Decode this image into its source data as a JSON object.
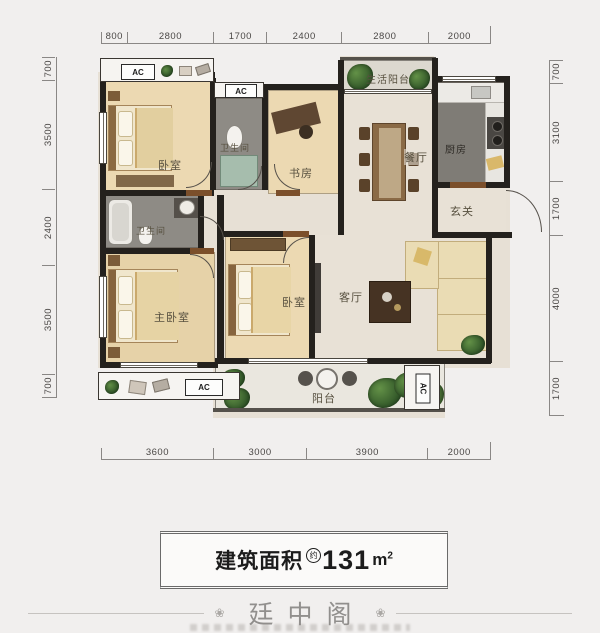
{
  "plan": {
    "dimensions": {
      "top": [
        "800",
        "2800",
        "1700",
        "2400",
        "2800",
        "2000"
      ],
      "bottom": [
        "3600",
        "3000",
        "3900",
        "2000"
      ],
      "left": [
        "700",
        "3500",
        "2400",
        "3500",
        "700"
      ],
      "right": [
        "700",
        "3100",
        "1700",
        "4000",
        "1700"
      ]
    },
    "rooms": {
      "bedroom_top": "卧室",
      "bath_top": "卫生间",
      "study": "书房",
      "service_balcony": "生活阳台",
      "dining": "餐厅",
      "kitchen": "厨房",
      "entry": "玄关",
      "bath_mid": "卫生间",
      "master_bedroom": "主卧室",
      "bedroom_mid": "卧室",
      "living": "客厅",
      "balcony": "阳台"
    },
    "ac_label": "AC"
  },
  "area_banner": {
    "label": "建筑面积",
    "approx": "约",
    "value": "131",
    "unit": "m",
    "unit_exp": "2"
  },
  "footer": {
    "title": "廷中阁",
    "ornament": "❀"
  },
  "colors": {
    "wall": "#24211d",
    "wood_floor": "#ecd9b2",
    "tile_floor": "#8e8b85",
    "marble_floor": "#e8e1d6",
    "plant_green": "#3f6b39",
    "background": "#f1efee"
  }
}
